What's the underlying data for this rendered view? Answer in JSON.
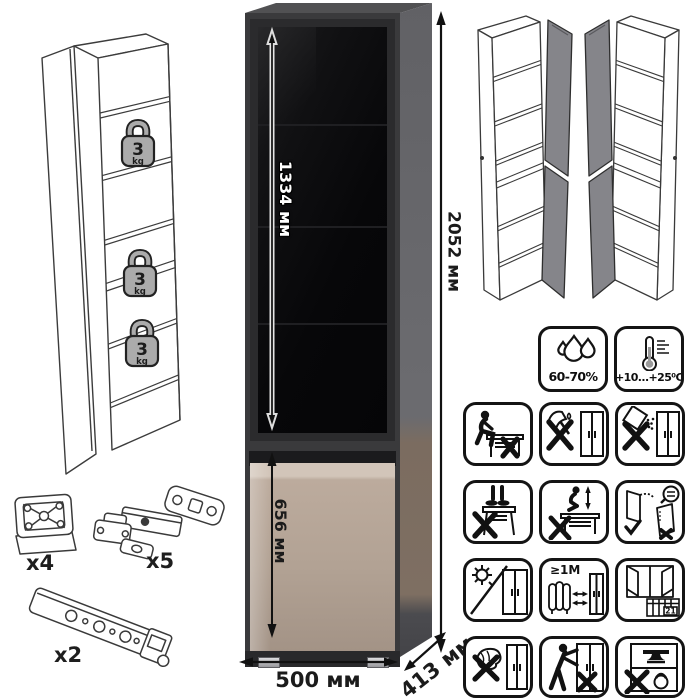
{
  "left_diagram": {
    "weights": [
      {
        "value": "3",
        "unit": "kg"
      },
      {
        "value": "3",
        "unit": "kg"
      },
      {
        "value": "3",
        "unit": "kg"
      }
    ]
  },
  "main_cabinet": {
    "dims": {
      "glass_height": "1334 мм",
      "total_height": "2052 мм",
      "lower_door_height": "656 мм",
      "width": "500 мм",
      "depth": "413 мм"
    },
    "colors": {
      "frame": "#3a3a3c",
      "glass": "#0a0a0c",
      "lower_door": "#b2a294",
      "side_panel": "#6b6b6f"
    }
  },
  "hardware": {
    "items": [
      {
        "name": "adjustable-foot",
        "qty": "x4"
      },
      {
        "name": "concealed-hinge",
        "qty": "x5"
      },
      {
        "name": "mounting-rail",
        "qty": "x2"
      }
    ]
  },
  "care_icons": {
    "humidity": "60-70%",
    "temperature": "+10...+25⁰C",
    "heater_distance": "≥1М",
    "calendar_day": "21",
    "tiles": [
      "humidity",
      "temperature",
      "no-sitting",
      "no-sharp-tools",
      "no-spilling",
      "no-standing",
      "no-jumping",
      "door-adjustment",
      "no-direct-sunlight",
      "heater-distance",
      "ventilation",
      "no-wet-cleaning",
      "no-dragging",
      "no-overloading"
    ]
  }
}
